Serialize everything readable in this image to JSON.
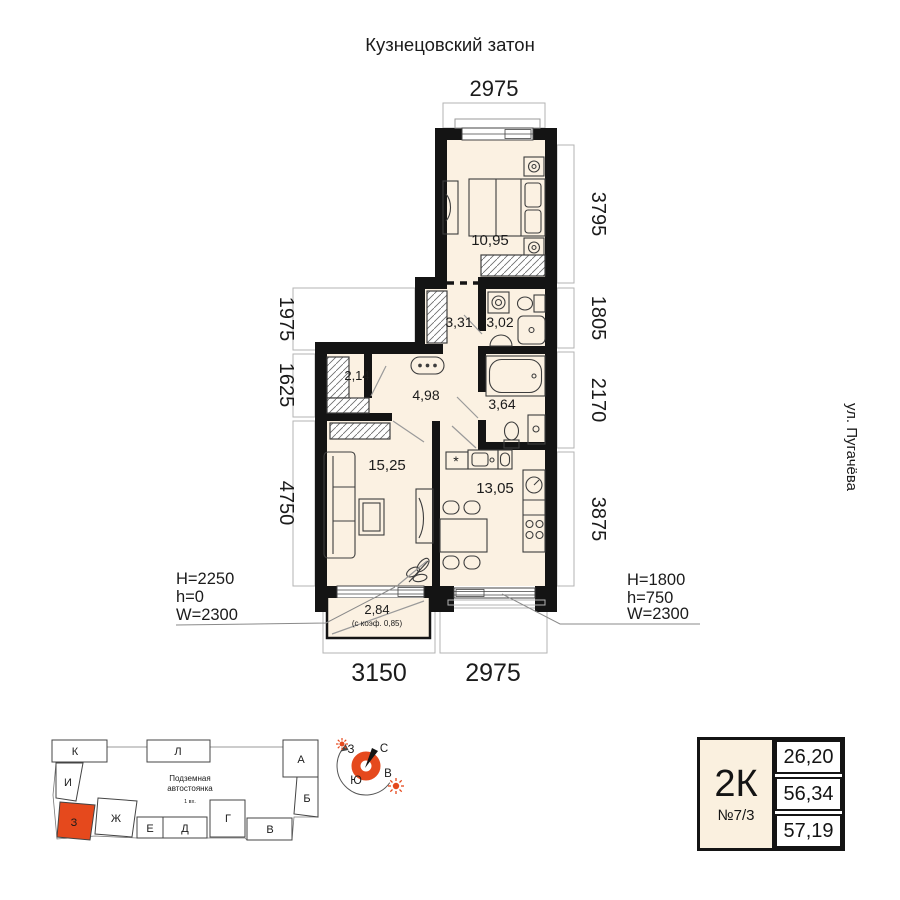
{
  "header": {
    "district": "Кузнецовский затон",
    "street": "ул. Пугачёва"
  },
  "dims": {
    "top": "2975",
    "right": [
      "3795",
      "1805",
      "2170",
      "3875"
    ],
    "left": [
      "1975",
      "1625",
      "4750"
    ],
    "bottom": [
      "3150",
      "2975"
    ]
  },
  "rooms": [
    {
      "id": "bedroom",
      "area": "10,95"
    },
    {
      "id": "hall",
      "area": "3,31"
    },
    {
      "id": "wc-small",
      "area": "3,02"
    },
    {
      "id": "closet",
      "area": "2,14"
    },
    {
      "id": "corridor",
      "area": "4,98"
    },
    {
      "id": "wc-large",
      "area": "3,64"
    },
    {
      "id": "living",
      "area": "15,25"
    },
    {
      "id": "kitchen",
      "area": "13,05"
    },
    {
      "id": "balcony",
      "area": "2,84",
      "note": "(с коэф. 0,85)"
    }
  ],
  "kitchen": {
    "stove_mark": "*"
  },
  "openings": {
    "left": {
      "lines": [
        "H=2250",
        "h=0",
        "W=2300"
      ]
    },
    "right": {
      "lines": [
        "H=1800",
        "h=750",
        "W=2300"
      ]
    }
  },
  "site": {
    "sections": [
      "К",
      "Л",
      "А",
      "И",
      "Б",
      "З",
      "Ж",
      "Е",
      "Д",
      "Г",
      "В"
    ],
    "highlighted": "З",
    "parking_line1": "Подземная",
    "parking_line2": "автостоянка",
    "parking_line3": "1 вх."
  },
  "compass": {
    "n": "С",
    "e": "В",
    "s": "Ю",
    "w": "З"
  },
  "card": {
    "type": "2К",
    "number": "№7/3",
    "areas": [
      "26,20",
      "56,34",
      "57,19"
    ]
  },
  "colors": {
    "accent": "#e5491d",
    "floor": "#fbf1e2",
    "wall": "#141414"
  }
}
